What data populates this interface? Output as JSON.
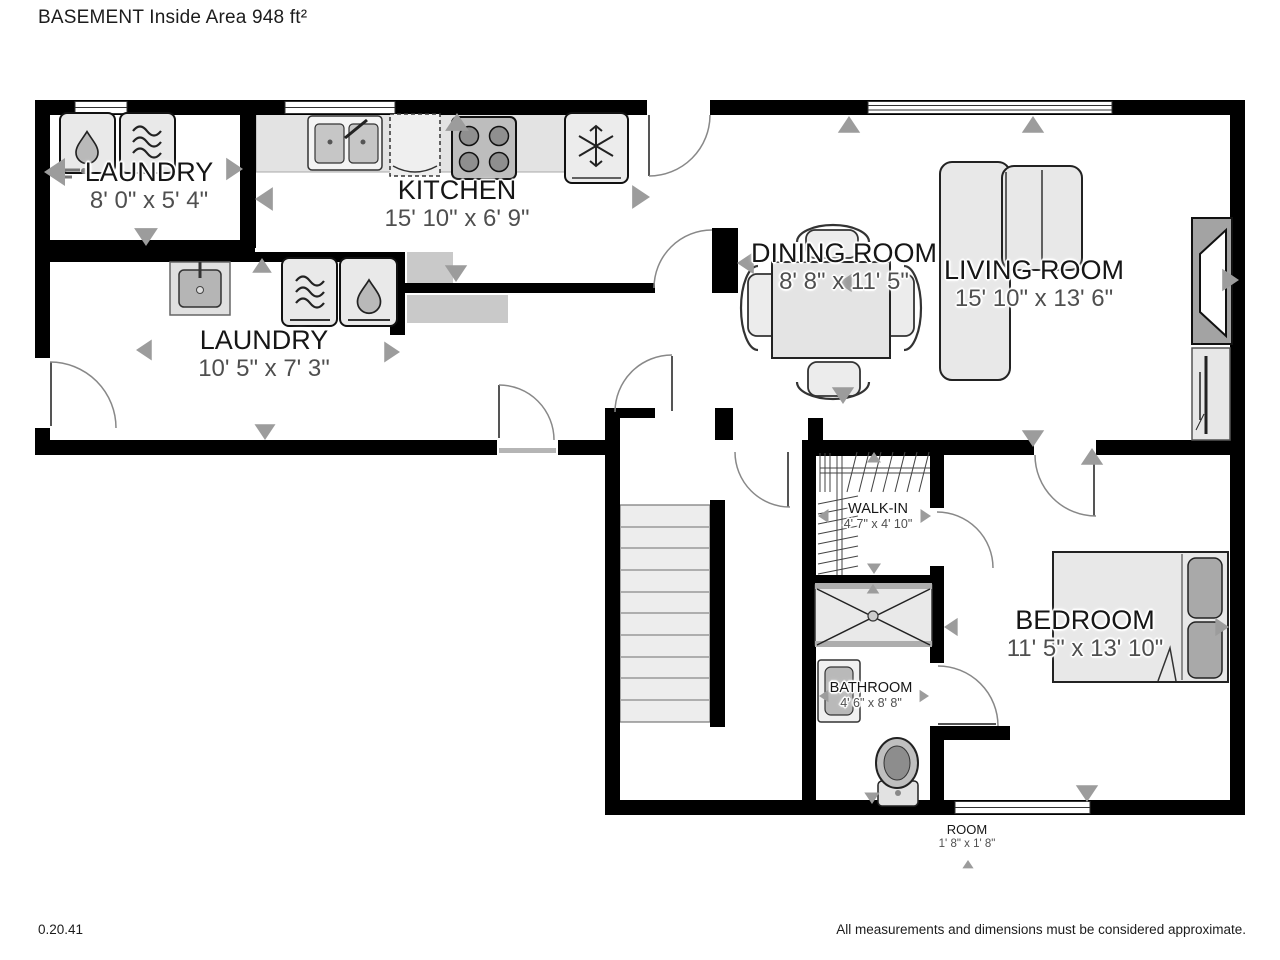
{
  "title": "BASEMENT Inside Area 948 ft²",
  "footer": {
    "version": "0.20.41",
    "disclaimer": "All measurements and dimensions must be considered approximate."
  },
  "colors": {
    "wall": "#000000",
    "fixture_fill": "#e8e8e8",
    "counter_fill": "#e3e3e3",
    "shelf_fill": "#c9c9c9",
    "stairs_fill": "#ededed",
    "arrow": "#9c9c9c",
    "room_text": "#161616",
    "dims_text": "#4f4f4f"
  },
  "icons": {
    "washer": "water-drop",
    "dryer": "waves",
    "refrigerator": "snowflake",
    "stove": "four-burners",
    "kitchen_sink": "double-basin",
    "dishwasher": "dashed-square",
    "toilet": "toilet",
    "bathtub": "x-cross-box",
    "shower": "shower-stall",
    "bed": "bed-with-pillows",
    "sofa": "l-sectional",
    "dining_table": "table-with-4-chairs",
    "fireplace": "fireplace-niche",
    "stairs": "straight-stairs"
  },
  "rooms": [
    {
      "id": "laundry-1",
      "name": "LAUNDRY",
      "dims": "8' 0\" x 5' 4\""
    },
    {
      "id": "kitchen",
      "name": "KITCHEN",
      "dims": "15' 10\" x 6' 9\""
    },
    {
      "id": "laundry-2",
      "name": "LAUNDRY",
      "dims": "10' 5\" x 7' 3\""
    },
    {
      "id": "dining-room",
      "name": "DINING ROOM",
      "dims": "8' 8\" x 11' 5\""
    },
    {
      "id": "living-room",
      "name": "LIVING ROOM",
      "dims": "15' 10\" x 13' 6\""
    },
    {
      "id": "walk-in",
      "name": "WALK-IN",
      "dims": "4' 7\" x 4' 10\""
    },
    {
      "id": "bedroom",
      "name": "BEDROOM",
      "dims": "11' 5\" x 13' 10\""
    },
    {
      "id": "bathroom",
      "name": "BATHROOM",
      "dims": "4' 6\" x 8' 8\""
    },
    {
      "id": "room",
      "name": "ROOM",
      "dims": "1' 8\" x 1' 8\""
    }
  ]
}
